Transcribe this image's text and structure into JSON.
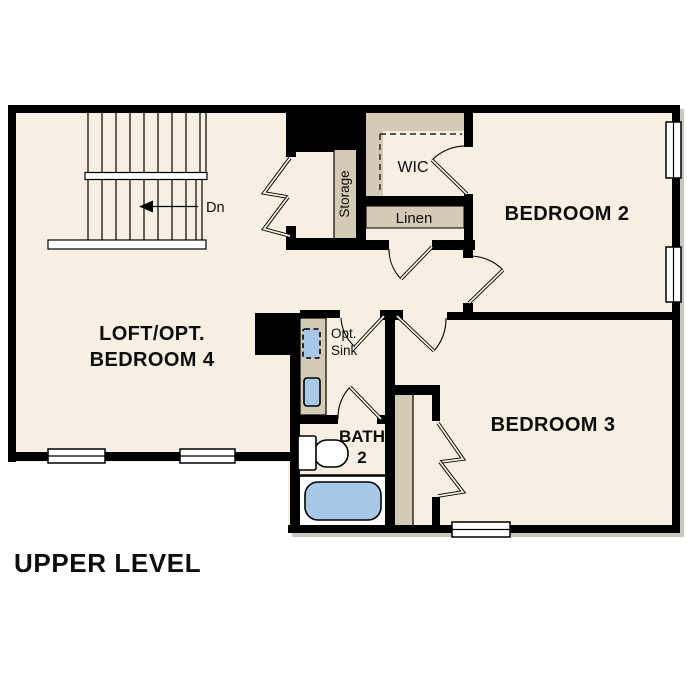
{
  "plan_title": "UPPER LEVEL",
  "colors": {
    "background": "#ffffff",
    "floor": "#f6efe2",
    "shelf": "#d5cab3",
    "fixture": "#a9c8e9",
    "wall": "#000000"
  },
  "rooms": {
    "loft": {
      "label_line1": "LOFT/OPT.",
      "label_line2": "BEDROOM 4"
    },
    "bedroom2": {
      "label": "BEDROOM 2"
    },
    "bedroom3": {
      "label": "BEDROOM 3"
    },
    "bath2": {
      "label_line1": "BATH",
      "label_line2": "2"
    },
    "wic": {
      "label": "WIC"
    },
    "linen": {
      "label": "Linen"
    },
    "storage": {
      "label": "Storage"
    }
  },
  "annotations": {
    "stair_direction": "Dn",
    "optional_sink_line1": "Opt.",
    "optional_sink_line2": "Sink"
  }
}
